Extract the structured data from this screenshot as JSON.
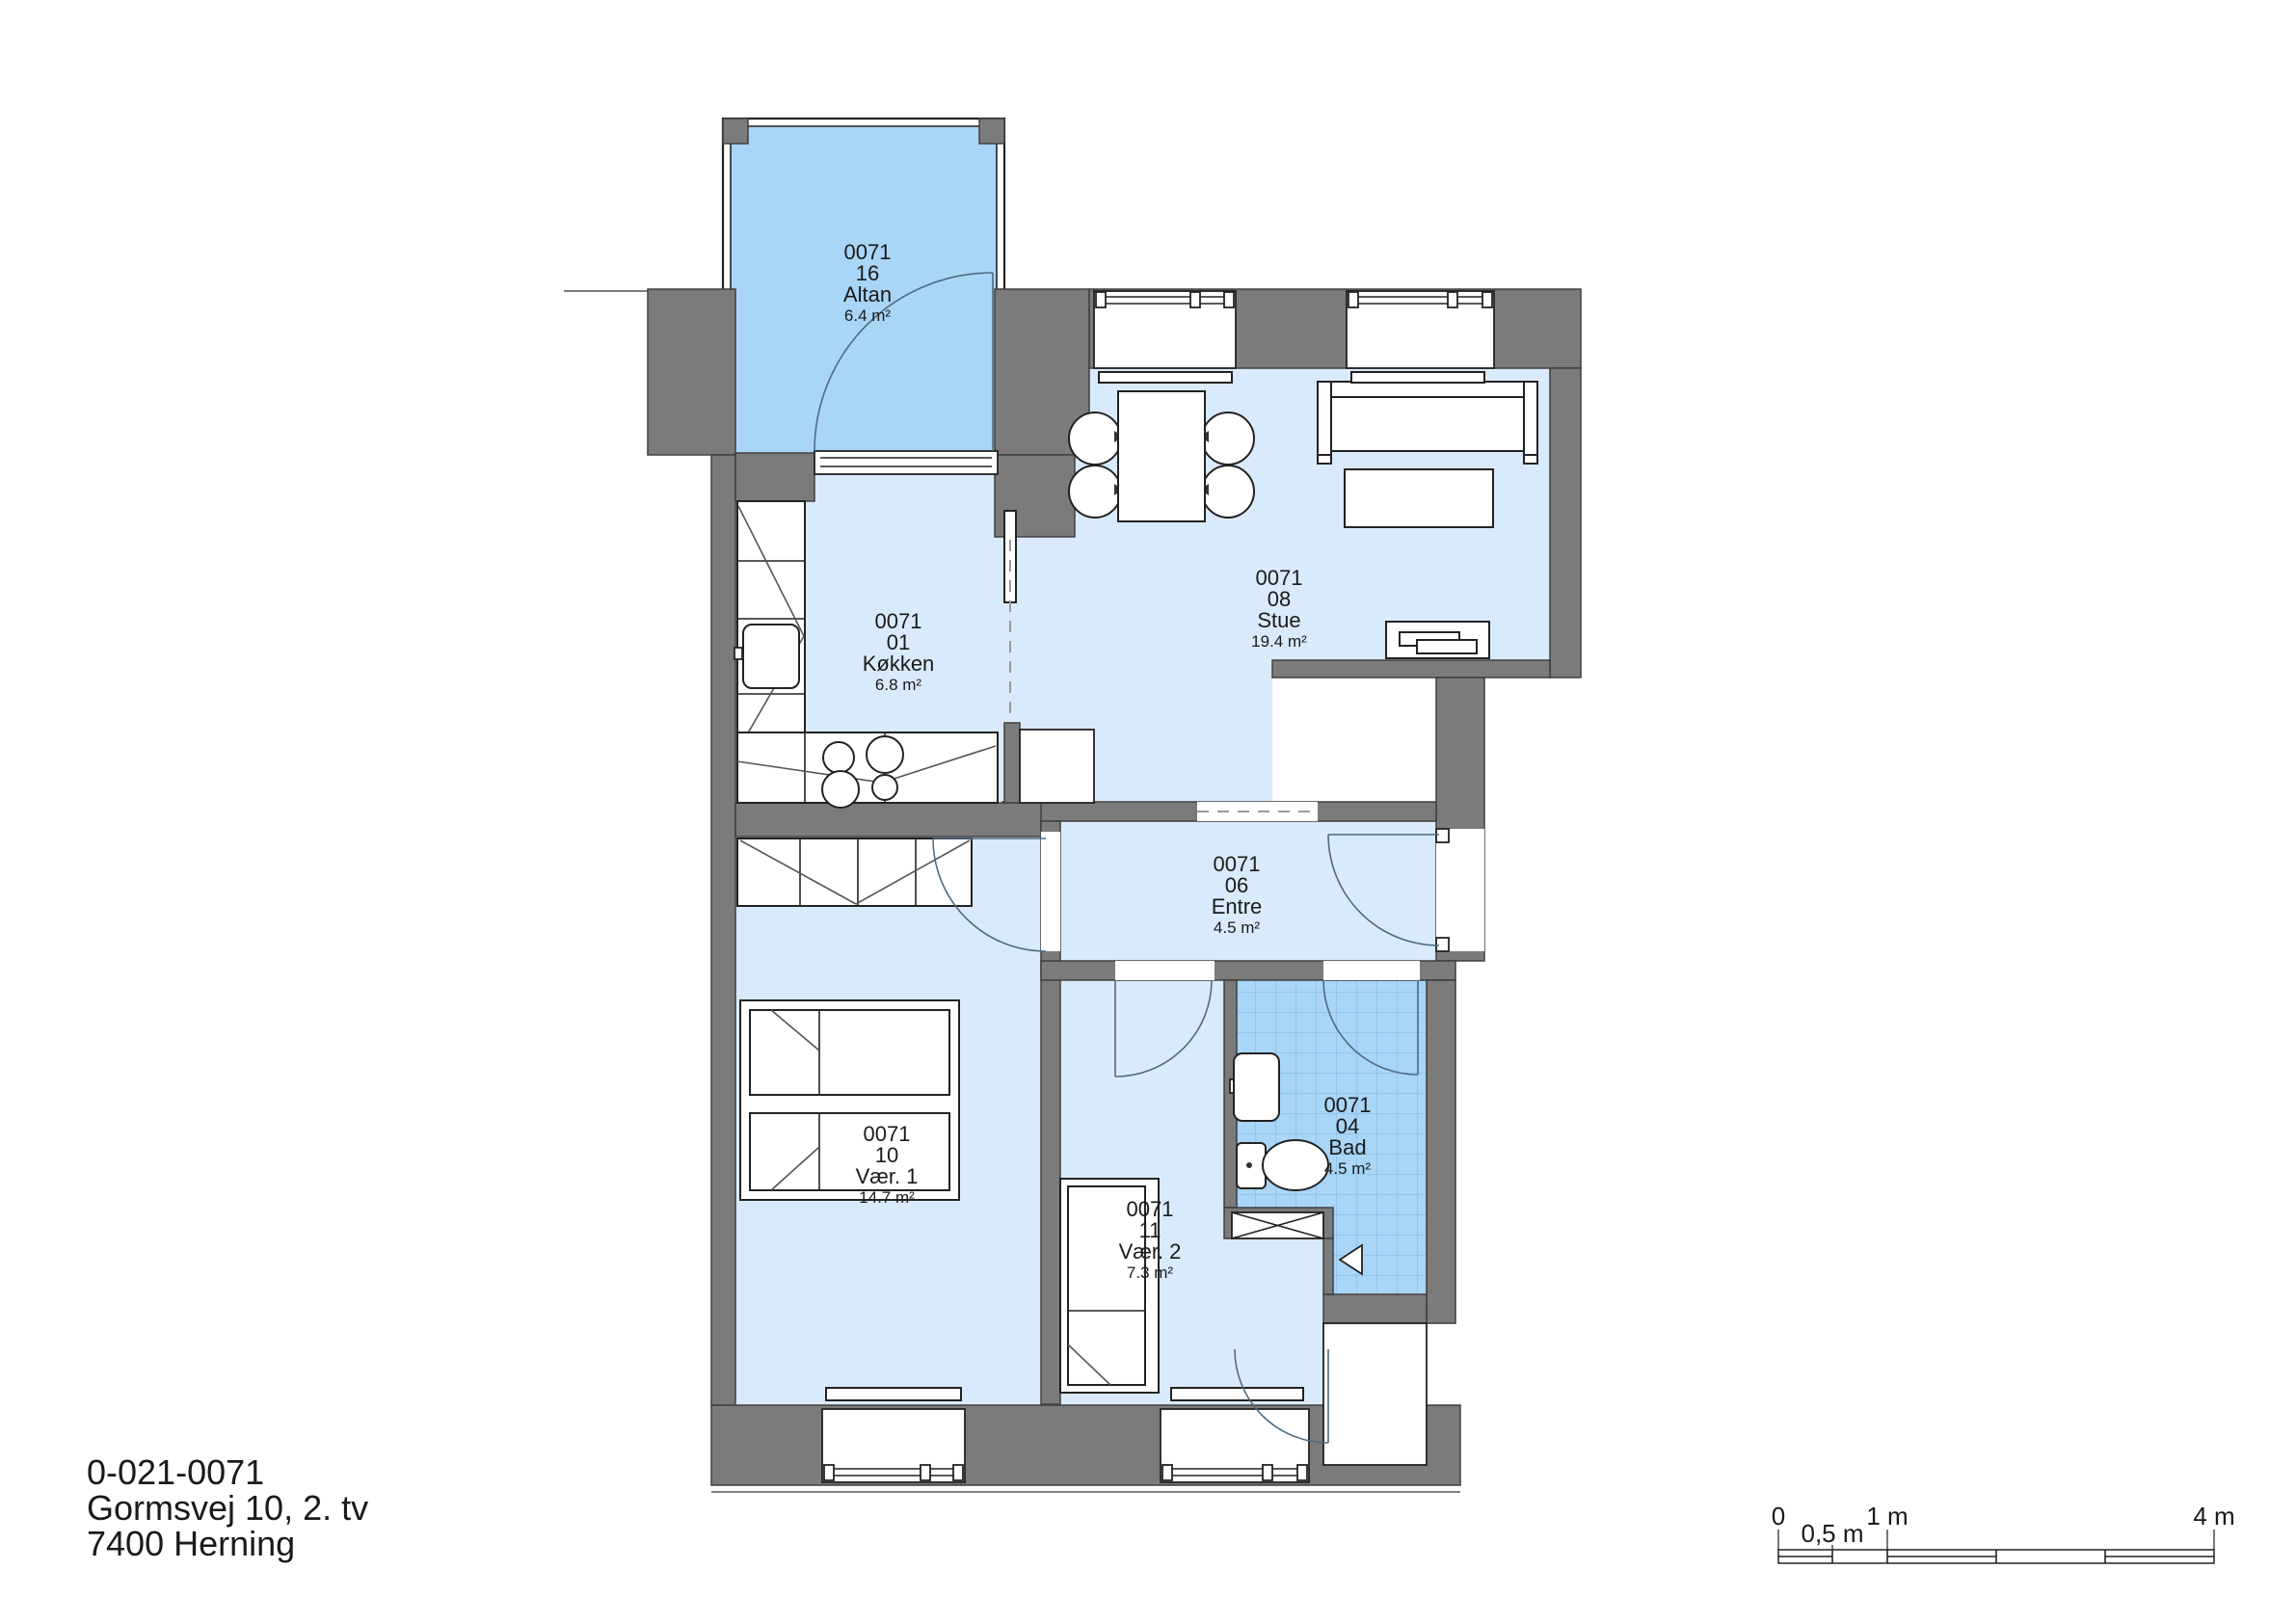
{
  "document": {
    "type": "architectural floor plan"
  },
  "rooms": {
    "altan": {
      "building_no": "0071",
      "room_no": "16",
      "name": "Altan",
      "area": "6.4 m²"
    },
    "koekken": {
      "building_no": "0071",
      "room_no": "01",
      "name": "Køkken",
      "area": "6.8 m²"
    },
    "stue": {
      "building_no": "0071",
      "room_no": "08",
      "name": "Stue",
      "area": "19.4 m²"
    },
    "entre": {
      "building_no": "0071",
      "room_no": "06",
      "name": "Entre",
      "area": "4.5 m²"
    },
    "vaer1": {
      "building_no": "0071",
      "room_no": "10",
      "name": "Vær. 1",
      "area": "14.7 m²"
    },
    "vaer2": {
      "building_no": "0071",
      "room_no": "11",
      "name": "Vær. 2",
      "area": "7.3 m²"
    },
    "bad": {
      "building_no": "0071",
      "room_no": "04",
      "name": "Bad",
      "area": "4.5 m²"
    }
  },
  "address": {
    "line1": "0-021-0071",
    "line2": "Gormsvej 10, 2. tv",
    "line3": "7400 Herning"
  },
  "scale_bar": {
    "label_0": "0",
    "label_05": "0,5 m",
    "label_1": "1 m",
    "label_4": "4 m"
  },
  "colors": {
    "wall": "#7b7b7b",
    "room_fill": "#d9eafc",
    "highlight_fill": "#a9d5f6",
    "tile_line": "#7fb3e3",
    "outline": "#222222"
  }
}
